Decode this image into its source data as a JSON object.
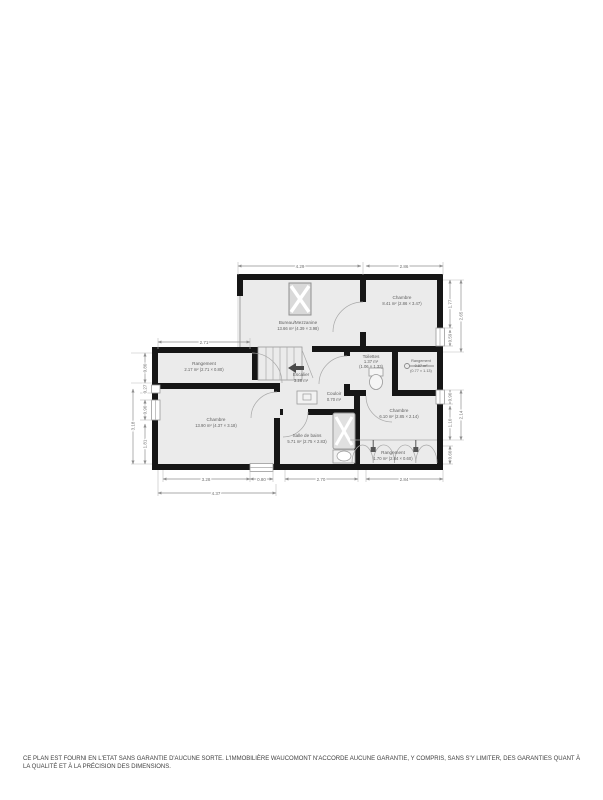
{
  "plan": {
    "colors": {
      "wall": "#161616",
      "floor": "#ebebeb",
      "fixture_line": "#9a9a9a",
      "dimension_text": "#6e6e6e",
      "label_text": "#5f5f5f",
      "stair_arrow": "#4a4a4a",
      "background": "#ffffff"
    },
    "rooms": {
      "bureau": {
        "name": "Bureau/Mezzanine",
        "details": "13.66 m² (4.39 × 3.98)"
      },
      "chambre_tr": {
        "name": "Chambre",
        "details": "8.41 m² (2.86 × 3.47)"
      },
      "rangement_left": {
        "name": "Rangement",
        "details": "2.17 m² (2.71 × 0.80)"
      },
      "chambre_left": {
        "name": "Chambre",
        "details": "13.90 m² (4.37 × 3.18)"
      },
      "escalier": {
        "name": "Escalier",
        "details": "3.28 m²"
      },
      "toilettes": {
        "name": "Toilettes",
        "area": "1.37 m²",
        "dims": "(1.06 × 1.33)"
      },
      "couloir": {
        "name": "Couloir",
        "details": "0.70 m²"
      },
      "salle_de_bains": {
        "name": "Salle de bains",
        "details": "5.71 m² (2.75 × 2.83)"
      },
      "chambre_br": {
        "name": "Chambre",
        "details": "6.10 m² (2.85 × 2.14)"
      },
      "rangement_br": {
        "name": "Rangement",
        "details": "1.70 m² (2.84 × 0.60)"
      },
      "placard": {
        "name": "Rangement",
        "area": "0.87 m²",
        "dims": "(0.77 × 1.13)"
      }
    },
    "dimensions": {
      "top": [
        "4.29",
        "2.86"
      ],
      "left_top": "2.71",
      "left_inner": [
        "0.80",
        "0.27",
        "0.90",
        "1.81"
      ],
      "left_outer": "3.18",
      "right_inner": [
        "1.77",
        "0.59",
        "0.90",
        "1.10",
        "0.60"
      ],
      "right_outer": [
        "2.65",
        "2.14"
      ],
      "bottom_inner": [
        "3.28",
        "0.80",
        "2.70",
        "2.84"
      ],
      "bottom_outer": "4.37"
    }
  },
  "footer": {
    "disclaimer": "CE PLAN EST FOURNI EN L'ETAT SANS GARANTIE D'AUCUNE SORTE. L'IMMOBILIÈRE WAUCOMONT N'ACCORDE AUCUNE GARANTIE, Y COMPRIS, SANS S'Y LIMITER, DES GARANTIES QUANT À LA QUALITÉ ET À LA PRÉCISION DES DIMENSIONS."
  }
}
